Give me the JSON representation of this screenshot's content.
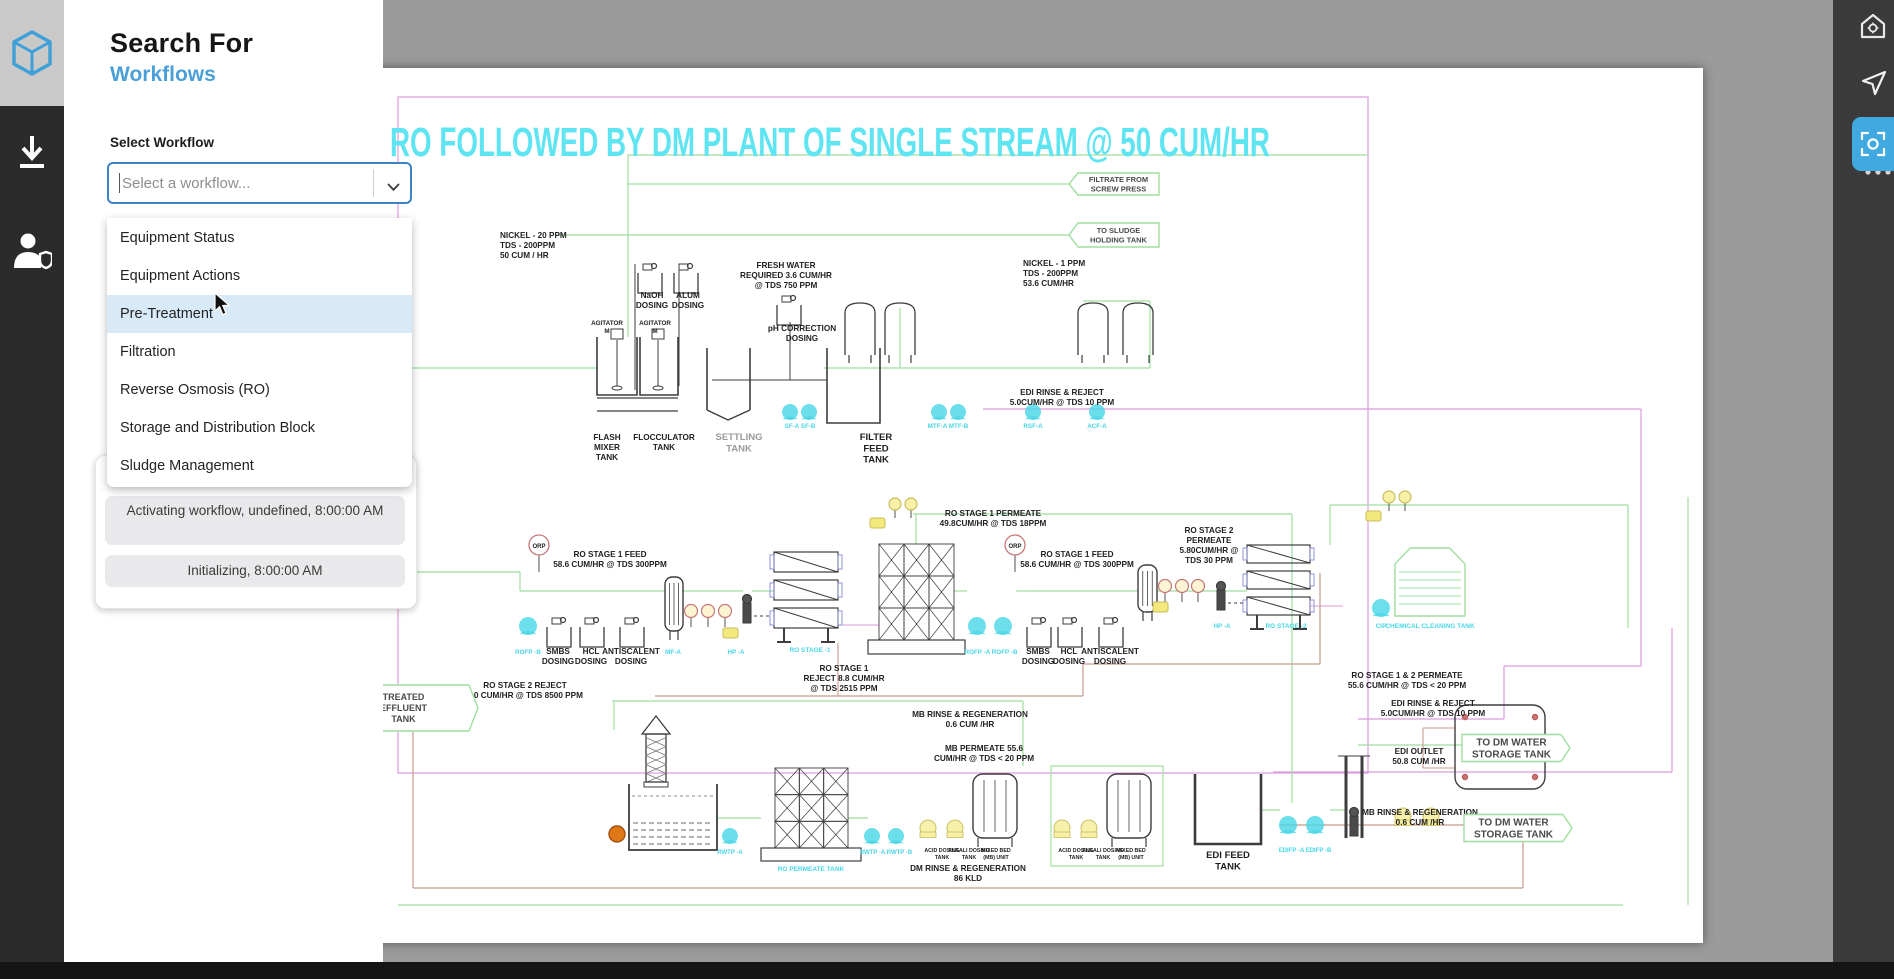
{
  "app": {
    "accent_blue": "#3fa9e0"
  },
  "left_sidebar": {
    "logo": "cube-logo",
    "icons": [
      {
        "name": "download-icon"
      },
      {
        "name": "user-shield-icon"
      }
    ]
  },
  "right_sidebar": {
    "icons": [
      {
        "name": "home-settings-icon",
        "active": false
      },
      {
        "name": "cursor-icon",
        "active": false
      },
      {
        "name": "scan-region-icon",
        "active": true
      },
      {
        "name": "ellipsis-icon",
        "active": false
      }
    ]
  },
  "panel": {
    "title": "Search For",
    "subtitle": "Workflows",
    "select_label": "Select Workflow",
    "dropdown_placeholder": "Select a workflow...",
    "options": [
      {
        "label": "Equipment Status",
        "highlighted": false
      },
      {
        "label": "Equipment Actions",
        "highlighted": false
      },
      {
        "label": "Pre-Treatment",
        "highlighted": true
      },
      {
        "label": "Filtration",
        "highlighted": false
      },
      {
        "label": "Reverse Osmosis (RO)",
        "highlighted": false
      },
      {
        "label": "Storage and Distribution Block",
        "highlighted": false
      },
      {
        "label": "Sludge Management",
        "highlighted": false
      }
    ],
    "status_messages": [
      "Activating workflow, undefined, 8:00:00 AM",
      "Initializing, 8:00:00 AM"
    ]
  },
  "diagram": {
    "title": "RO FOLLOWED BY DM PLANT OF SINGLE STREAM @ 50 CUM/HR",
    "title_color": "#5fe4f2",
    "colors": {
      "green": "#9fdf9f",
      "purple": "#dc9ade",
      "brown": "#c89a8c",
      "cyan": "#49d6e6",
      "yellow": "#f7f0a6",
      "ink": "#1f1f1f",
      "gray": "#9a9a9a"
    },
    "labels": [
      {
        "text": "NICKEL - 20 PPM\nTDS - 200PPM\n50 CUM / HR",
        "x": 117,
        "y": 170,
        "anchor": "start"
      },
      {
        "text": "NaOH\nDOSING",
        "x": 269,
        "y": 230
      },
      {
        "text": "ALUM\nDOSING",
        "x": 305,
        "y": 230
      },
      {
        "text": "AGITATOR\nM",
        "x": 224,
        "y": 257,
        "size": 6.3
      },
      {
        "text": "AGITATOR\nM",
        "x": 272,
        "y": 257,
        "size": 6.3
      },
      {
        "text": "pH CORRECTION\nDOSING",
        "x": 419,
        "y": 263
      },
      {
        "text": "FRESH WATER\nREQUIRED 3.6 CUM/HR\n@ TDS 750 PPM",
        "x": 403,
        "y": 200
      },
      {
        "text": "NICKEL - 1 PPM\nTDS - 200PPM\n53.6 CUM/HR",
        "x": 640,
        "y": 198,
        "anchor": "start"
      },
      {
        "text": "FLASH\nMIXER\nTANK",
        "x": 224,
        "y": 372
      },
      {
        "text": "FLOCCULATOR\nTANK",
        "x": 281,
        "y": 372
      },
      {
        "text": "SETTLING\nTANK",
        "x": 356,
        "y": 372,
        "color": "gray",
        "size": 9.5
      },
      {
        "text": "FILTER\nFEED\nTANK",
        "x": 493,
        "y": 372,
        "size": 9.5
      },
      {
        "text": "SF-A  SF-B",
        "x": 417,
        "y": 360,
        "color": "cyan",
        "size": 6.3
      },
      {
        "text": "MTF-A  MTF-B",
        "x": 565,
        "y": 360,
        "color": "cyan",
        "size": 6.3
      },
      {
        "text": "RSF-A",
        "x": 650,
        "y": 360,
        "color": "cyan",
        "size": 6.3
      },
      {
        "text": "ACF-A",
        "x": 714,
        "y": 360,
        "color": "cyan",
        "size": 6.3
      },
      {
        "text": "ORP",
        "x": 156,
        "y": 480,
        "size": 6
      },
      {
        "text": "RO STAGE 1 FEED\n58.6 CUM/HR @ TDS 300PPM",
        "x": 227,
        "y": 489
      },
      {
        "text": "SMBS\nDOSING",
        "x": 175,
        "y": 586
      },
      {
        "text": "HCL\nDOSING",
        "x": 208,
        "y": 586
      },
      {
        "text": "ANTISCALENT\nDOSING",
        "x": 248,
        "y": 586
      },
      {
        "text": "MF-A",
        "x": 290,
        "y": 586,
        "color": "cyan",
        "size": 6.3
      },
      {
        "text": "HP -A",
        "x": 353,
        "y": 586,
        "color": "cyan",
        "size": 6.3
      },
      {
        "text": "RO STAGE -1",
        "x": 427,
        "y": 584,
        "color": "cyan",
        "size": 6.5
      },
      {
        "text": "RO STAGE 1\nREJECT 8.8 CUM/HR\n@ TDS 2515 PPM",
        "x": 461,
        "y": 603
      },
      {
        "text": "RO STAGE 1 PERMEATE\n49.8CUM/HR @ TDS 18PPM",
        "x": 610,
        "y": 448
      },
      {
        "text": "ORP",
        "x": 632,
        "y": 480,
        "size": 6
      },
      {
        "text": "RO STAGE 1 FEED\n58.6 CUM/HR @ TDS 300PPM",
        "x": 694,
        "y": 489
      },
      {
        "text": "SMBS\nDOSING",
        "x": 655,
        "y": 586
      },
      {
        "text": "HCL\nDOSING",
        "x": 686,
        "y": 586
      },
      {
        "text": "ANTISCALENT\nDOSING",
        "x": 727,
        "y": 586
      },
      {
        "text": "ROFP -A  ROFP -B",
        "x": 608,
        "y": 586,
        "color": "cyan",
        "size": 6.3
      },
      {
        "text": "ROFP -B",
        "x": 145,
        "y": 586,
        "color": "cyan",
        "size": 6.3
      },
      {
        "text": "EDI RINSE & REJECT\n5.0CUM/HR @ TDS 10 PPM",
        "x": 679,
        "y": 327
      },
      {
        "text": "RO STAGE 2\nPERMEATE\n5.80CUM/HR @\nTDS 30 PPM",
        "x": 826,
        "y": 465
      },
      {
        "text": "HP -A",
        "x": 839,
        "y": 560,
        "color": "cyan",
        "size": 6.3
      },
      {
        "text": "RO STAGE -2",
        "x": 903,
        "y": 560,
        "color": "cyan",
        "size": 6.5
      },
      {
        "text": "CIP",
        "x": 998,
        "y": 560,
        "color": "cyan",
        "size": 6.5
      },
      {
        "text": "CHEMICAL CLEANING TANK",
        "x": 1047,
        "y": 560,
        "color": "cyan",
        "size": 6.5
      },
      {
        "text": "RO STAGE 1 & 2 PERMEATE\n55.6 CUM/HR @ TDS < 20 PPM",
        "x": 1024,
        "y": 610
      },
      {
        "text": "RO STAGE 2 REJECT\n3.0 CUM/HR @ TDS 8500 PPM",
        "x": 142,
        "y": 620
      },
      {
        "text": "MB RINSE & REGENERATION\n0.6 CUM /HR",
        "x": 587,
        "y": 649
      },
      {
        "text": "MB PERMEATE 55.6\nCUM/HR @ TDS < 20 PPM",
        "x": 601,
        "y": 683
      },
      {
        "text": "RO PERMEATE TANK",
        "x": 428,
        "y": 803,
        "color": "cyan",
        "size": 6.5
      },
      {
        "text": "RWTP -A",
        "x": 347,
        "y": 786,
        "color": "cyan",
        "size": 6
      },
      {
        "text": "RWTP -A  RWTP -B",
        "x": 503,
        "y": 786,
        "color": "cyan",
        "size": 6
      },
      {
        "text": "ACID DOSING\nTANK",
        "x": 559,
        "y": 784,
        "size": 5.3
      },
      {
        "text": "ALKALI DOSING\nTANK",
        "x": 586,
        "y": 784,
        "size": 5.3
      },
      {
        "text": "MIXED BED\n(MB) UNIT",
        "x": 613,
        "y": 784,
        "size": 5.3
      },
      {
        "text": "ACID DOSING\nTANK",
        "x": 693,
        "y": 784,
        "size": 5.3
      },
      {
        "text": "ALKALI DOSING\nTANK",
        "x": 720,
        "y": 784,
        "size": 5.3
      },
      {
        "text": "MIXED BED\n(MB) UNIT",
        "x": 748,
        "y": 784,
        "size": 5.3
      },
      {
        "text": "DM RINSE & REGENERATION\n86 KLD",
        "x": 585,
        "y": 803
      },
      {
        "text": "EDI FEED\nTANK",
        "x": 845,
        "y": 790,
        "size": 9.5
      },
      {
        "text": "EDIFP -A  EDIFP -B",
        "x": 922,
        "y": 784,
        "color": "cyan",
        "size": 6
      },
      {
        "text": "EDI RINSE & REJECT\n5.0CUM/HR @ TDS 10 PPM",
        "x": 1050,
        "y": 638
      },
      {
        "text": "EDI OUTLET\n50.8 CUM /HR",
        "x": 1036,
        "y": 686
      },
      {
        "text": "MB RINSE & REGENERATION\n0.6 CUM /HR",
        "x": 1037,
        "y": 747
      }
    ],
    "flags": [
      {
        "text": "FILTRATE FROM\nSCREW PRESS",
        "cx": 731,
        "cy": 116,
        "w": 90,
        "h": 22,
        "dir": "left",
        "size": 7.5
      },
      {
        "text": "TO SLUDGE\nHOLDING TANK",
        "cx": 731,
        "cy": 167,
        "w": 90,
        "h": 24,
        "dir": "left",
        "size": 7.5
      },
      {
        "text": "TO DM WATER\nSTORAGE TANK",
        "cx": 1133,
        "cy": 680,
        "w": 108,
        "h": 27,
        "dir": "right",
        "size": 10
      },
      {
        "text": "TO DM WATER\nSTORAGE TANK",
        "cx": 1135,
        "cy": 760,
        "w": 108,
        "h": 27,
        "dir": "right",
        "size": 10
      },
      {
        "text": "TREATED\nEFFLUENT\nTANK",
        "cx": 25,
        "cy": 640,
        "w": 140,
        "h": 46,
        "dir": "right",
        "size": 9
      }
    ]
  }
}
